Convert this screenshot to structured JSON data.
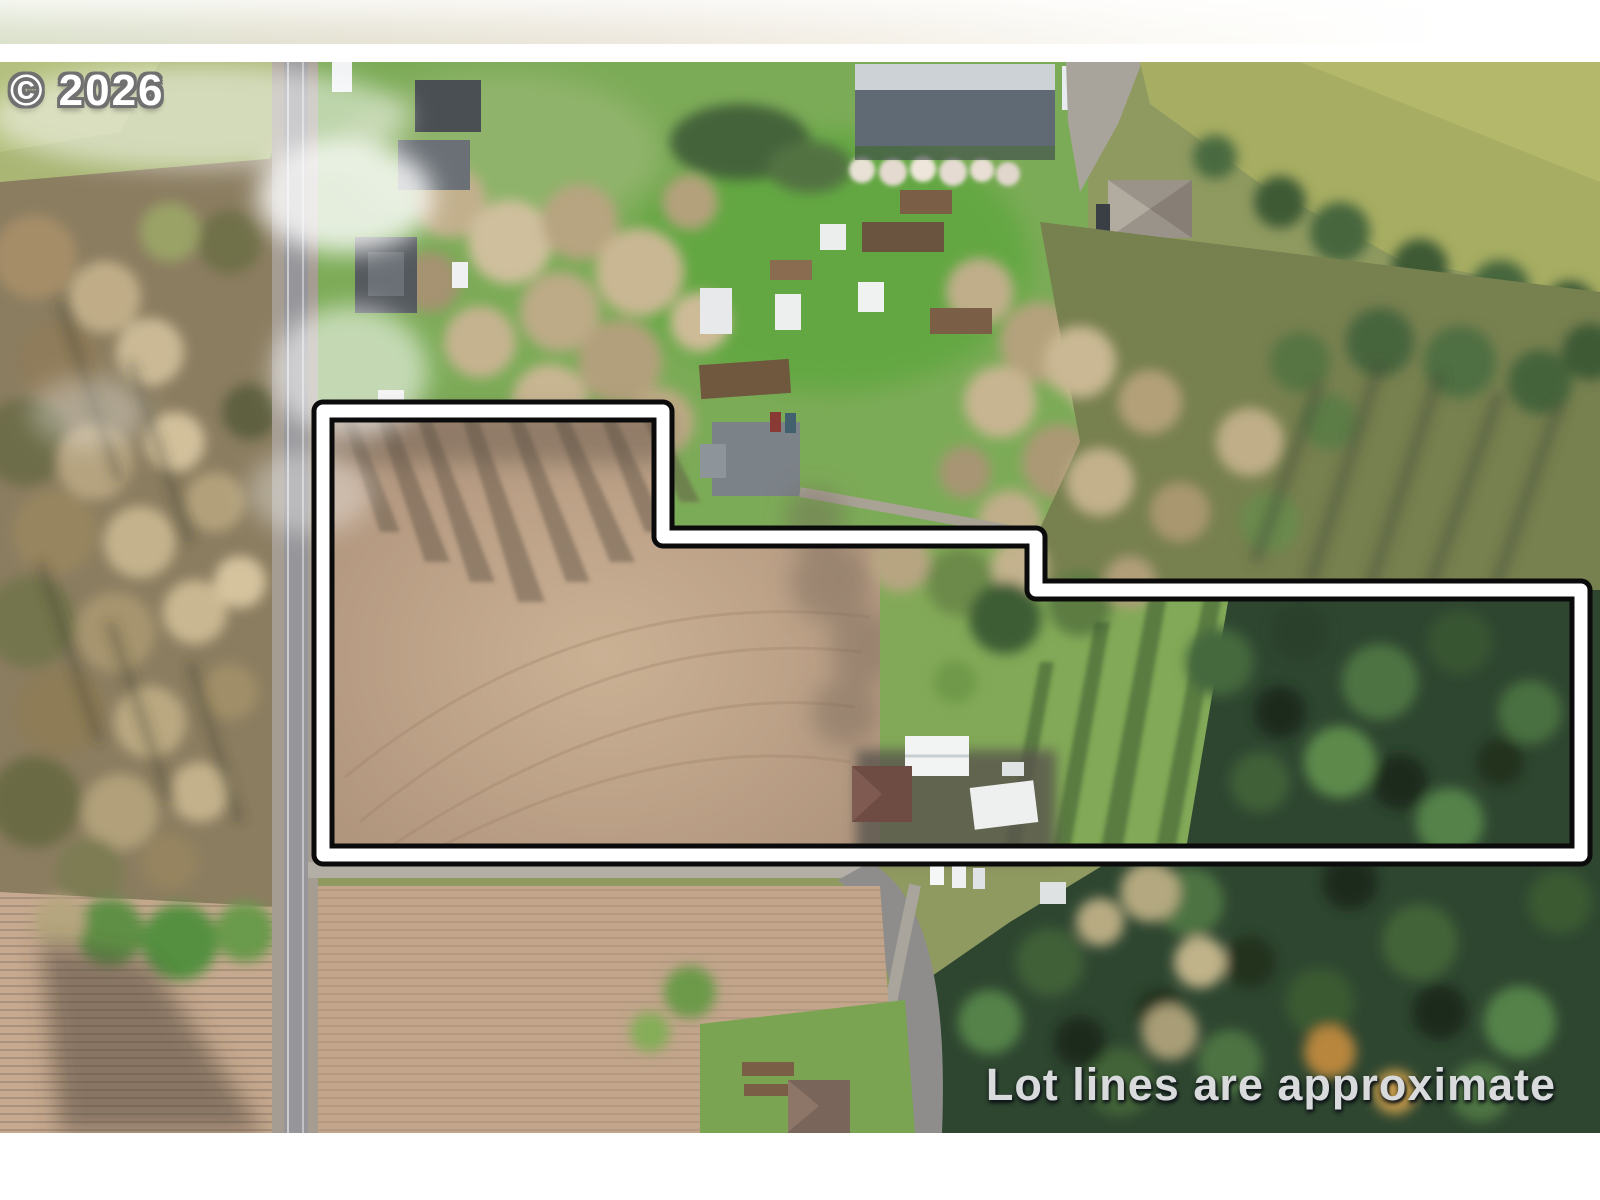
{
  "watermark": {
    "text": "© 2026",
    "color": "#ffffff",
    "outline_color": "#707070"
  },
  "disclaimer": {
    "text": "Lot lines are approximate",
    "color": "#d9dadc"
  },
  "lot_outline": {
    "points": "323,349 663,349 663,475 1036,475 1036,528 1581,528 1581,793 323,793",
    "outline_color": "#0b0b0b",
    "line_color": "#ffffff"
  }
}
